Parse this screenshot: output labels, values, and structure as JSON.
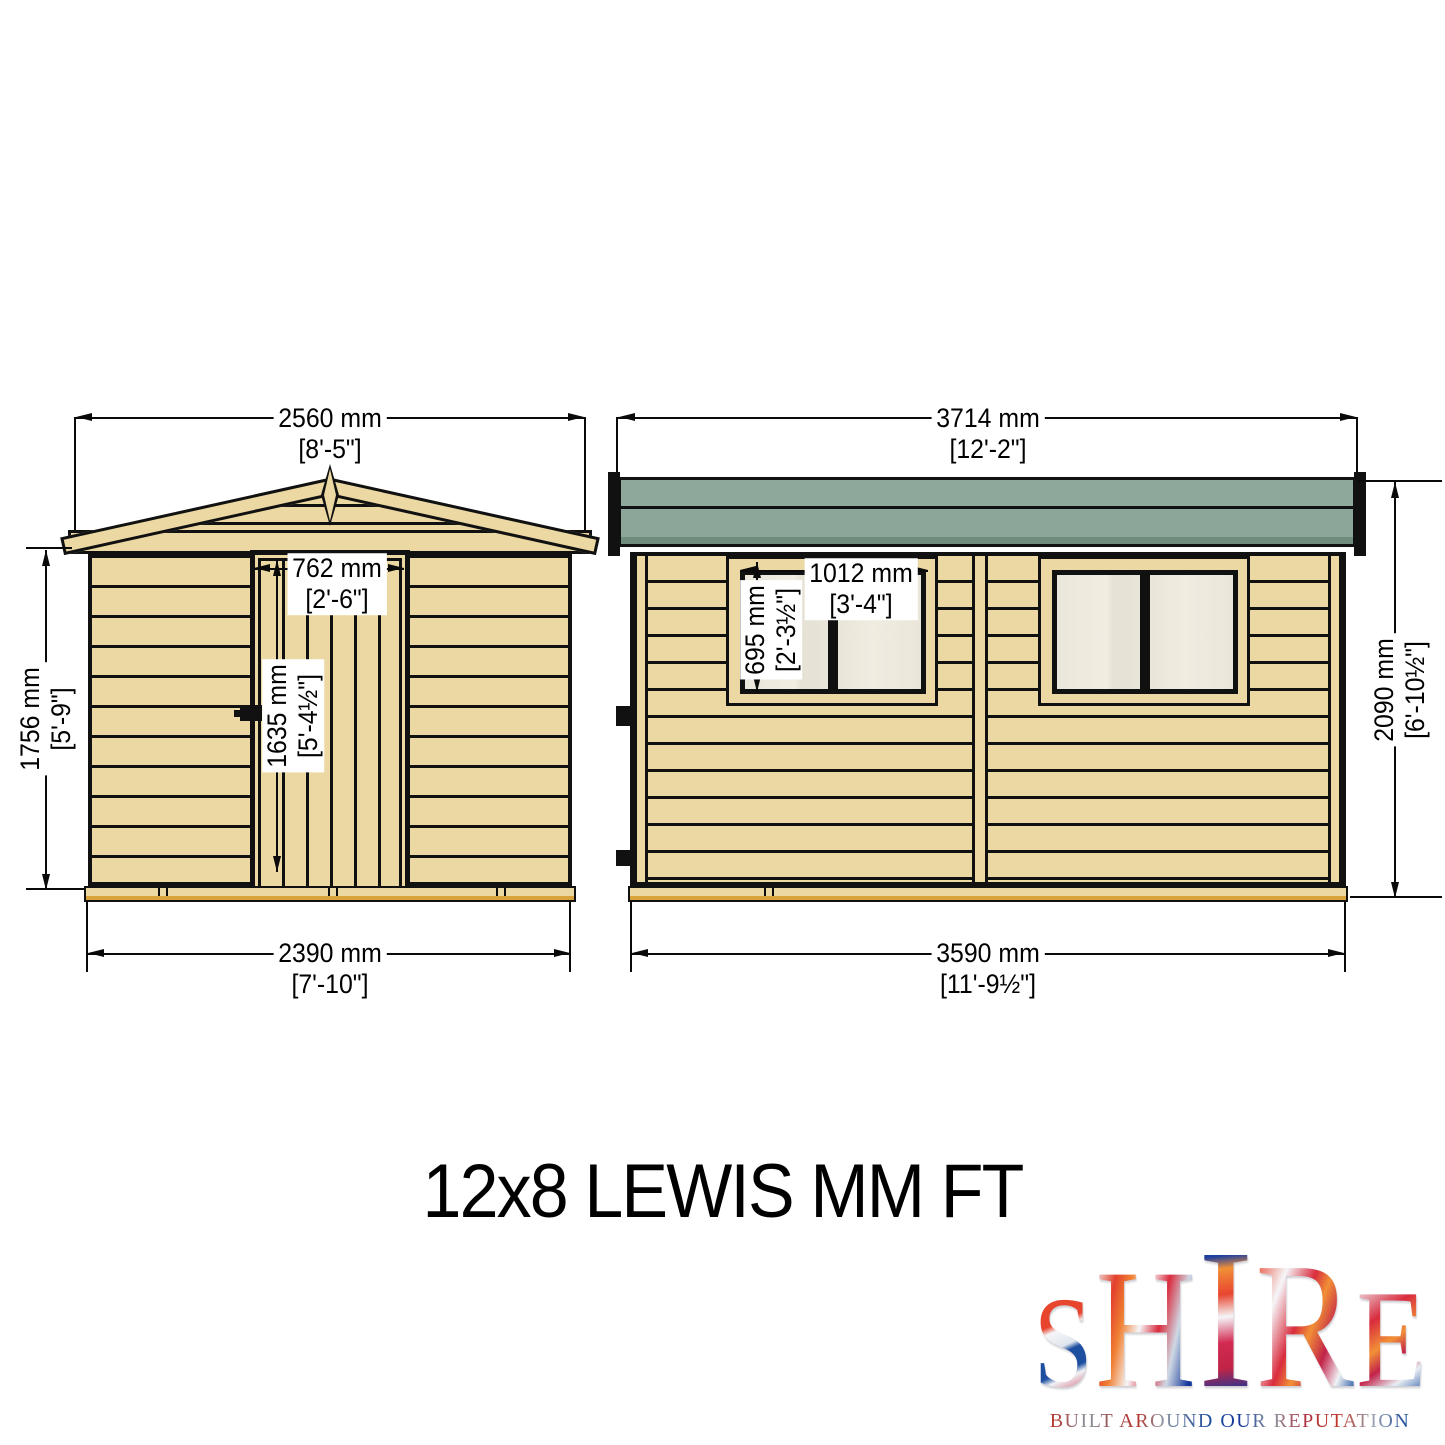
{
  "title": "12x8 LEWIS MM FT",
  "views": {
    "front": {
      "overall_width": {
        "mm": "2560 mm",
        "ft": "[8'-5\"]"
      },
      "wall_height": {
        "mm": "1756 mm",
        "ft": "[5'-9\"]"
      },
      "door_width": {
        "mm": "762 mm",
        "ft": "[2'-6\"]"
      },
      "door_height": {
        "mm": "1635 mm",
        "ft": "[5'-4½\"]"
      },
      "base_width": {
        "mm": "2390 mm",
        "ft": "[7'-10\"]"
      }
    },
    "side": {
      "overall_width": {
        "mm": "3714 mm",
        "ft": "[12'-2\"]"
      },
      "window_width": {
        "mm": "1012 mm",
        "ft": "[3'-4\"]"
      },
      "window_height": {
        "mm": "695 mm",
        "ft": "[2'-3½\"]"
      },
      "overall_height": {
        "mm": "2090 mm",
        "ft": "[6'-10½\"]"
      },
      "base_width": {
        "mm": "3590 mm",
        "ft": "[11'-9½\"]"
      }
    }
  },
  "logo": {
    "letters": [
      "S",
      "H",
      "I",
      "R",
      "E"
    ],
    "tagline": "BUILT AROUND OUR REPUTATION"
  },
  "colors": {
    "wood": "#ecd8a2",
    "outline": "#111111",
    "roof_green": "#8ca69a",
    "roof_green_dark": "#6f8d7d",
    "glass": "#eae6da",
    "base_gold": "#d9a33c"
  }
}
